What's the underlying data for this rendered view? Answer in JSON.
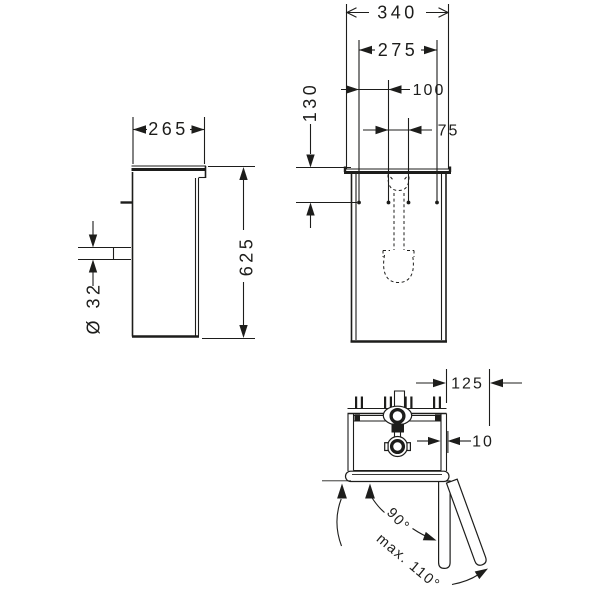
{
  "colors": {
    "background": "#ffffff",
    "line": "#1d1d1b"
  },
  "front_view": {
    "overall_width": "340",
    "mounting_width": "275",
    "hole_spacing_a": "100",
    "hole_spacing_b": "75",
    "mounting_depth_from_top": "130"
  },
  "side_view": {
    "depth": "265",
    "height": "625",
    "outlet_diameter": "Ø 32"
  },
  "top_view": {
    "side_clearance": "125",
    "door_thickness": "10",
    "door_opening_angle": "90°",
    "door_opening_angle_max": "max. 110°"
  }
}
